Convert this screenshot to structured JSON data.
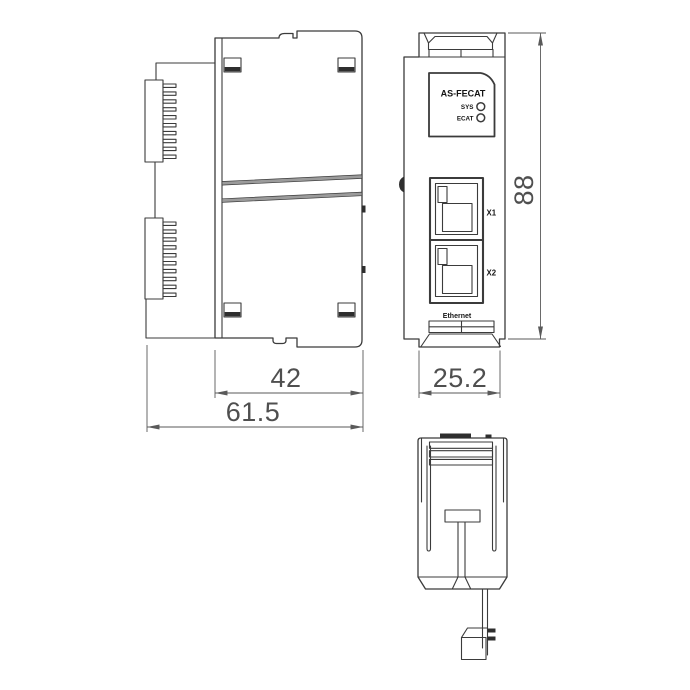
{
  "front_view": {
    "plate": {
      "title": "AS-FECAT",
      "led_sys": "SYS",
      "led_ecat": "ECAT"
    },
    "ports": {
      "x1": "X1",
      "x2": "X2",
      "caption": "Ethernet"
    }
  },
  "dimensions": {
    "body_depth": "42",
    "overall_depth": "61.5",
    "module_width": "25.2",
    "module_height": "88"
  },
  "colors": {
    "outline": "#3b3b3b",
    "dimension_line": "#5a5a5a",
    "dimension_text": "#4f4f4f",
    "dark_fill": "#2e2e2e",
    "background": "#ffffff"
  }
}
